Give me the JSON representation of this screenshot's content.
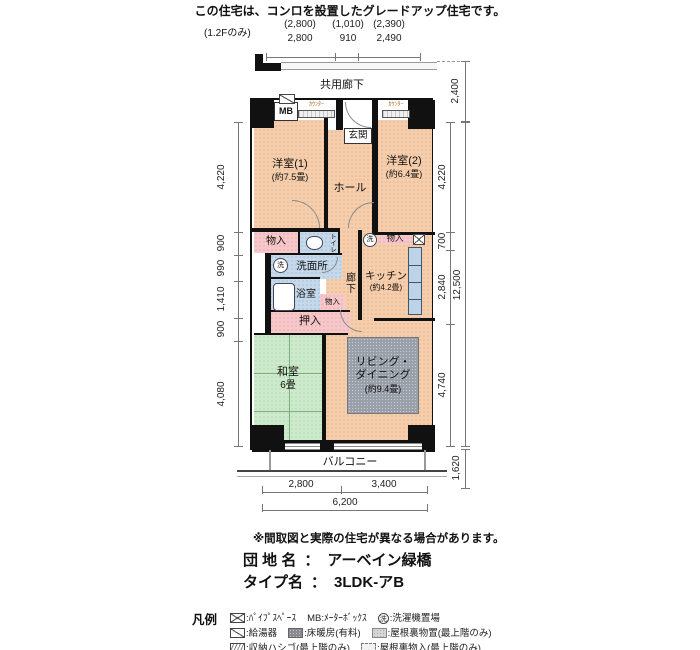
{
  "page": {
    "top_note": "この住宅は、コンロを設置したグレードアップ住宅です。",
    "floor_only_note": "(1.2Fのみ)"
  },
  "dims": {
    "top": [
      {
        "paren": "(2,800)",
        "val": "2,800"
      },
      {
        "paren": "(1,010)",
        "val": "910"
      },
      {
        "paren": "(2,390)",
        "val": "2,490"
      }
    ],
    "left": [
      "4,220",
      "900",
      "990",
      "1,410",
      "900",
      "4,080"
    ],
    "right": {
      "corridor": "2,400",
      "segments": [
        "4,220",
        "700",
        "2,840",
        "4,740"
      ],
      "total": "12,500",
      "balcony": "1,620"
    },
    "bottom": {
      "segments": [
        "2,800",
        "3,400"
      ],
      "total": "6,200"
    }
  },
  "plan": {
    "corridor_label": "共用廊下",
    "balcony_label": "バルコニー",
    "mb": "MB",
    "counter_left": "ｶｳﾝﾀｰ",
    "counter_right": "ｶｳﾝﾀｰ",
    "genkan": "玄関",
    "hall": "ホール",
    "yoshitsu1": {
      "name": "洋室(1)",
      "size": "(約7.5畳)"
    },
    "yoshitsu2": {
      "name": "洋室(2)",
      "size": "(約6.4畳)"
    },
    "storage_left": "物入",
    "toilet": "トイレ",
    "washroom": "洗面所",
    "bathroom": "浴室",
    "storage_mid": "物入",
    "corridor_inner": "廊下",
    "kitchen": {
      "name": "キッチン",
      "size": "(約4.2畳)"
    },
    "storage_right": "物入",
    "washer_mark": "洗",
    "oshiire": "押入",
    "washitsu": {
      "name": "和室",
      "size": "6畳"
    },
    "living": {
      "name": "リビング・\nダイニング",
      "size": "(約9.4畳)"
    }
  },
  "footer": {
    "disclaimer": "※間取図と実際の住宅が異なる場合があります。",
    "estate_label": "団 地 名",
    "estate_colon": "：",
    "estate_name": "アーベイン緑橋",
    "type_label": "タイプ名",
    "type_colon": "：",
    "type_name": "3LDK-アB"
  },
  "legend": {
    "title": "凡例",
    "washer_char": "洗",
    "row1": [
      {
        "icon": "pipe-space-icon",
        "label": ":ﾊﾟｲﾌﾟｽﾍﾟｰｽ"
      },
      {
        "icon": "none",
        "label": "MB:ﾒｰﾀｰﾎﾞｯｸｽ"
      },
      {
        "icon": "washer-icon",
        "label": ":洗濯機置場"
      }
    ],
    "row2": [
      {
        "icon": "water-heater-icon",
        "label": ":給湯器"
      },
      {
        "icon": "floor-heating-icon",
        "label": ":床暖房(有料)"
      },
      {
        "icon": "attic-storage-icon",
        "label": ":屋根裏物置(最上階のみ)"
      }
    ],
    "row3": [
      {
        "icon": "storage-ladder-icon",
        "label": ":収納ハシゴ(最上階のみ)"
      },
      {
        "icon": "attic-closet-icon",
        "label": ":屋根裏物入(最上階のみ)"
      }
    ]
  }
}
